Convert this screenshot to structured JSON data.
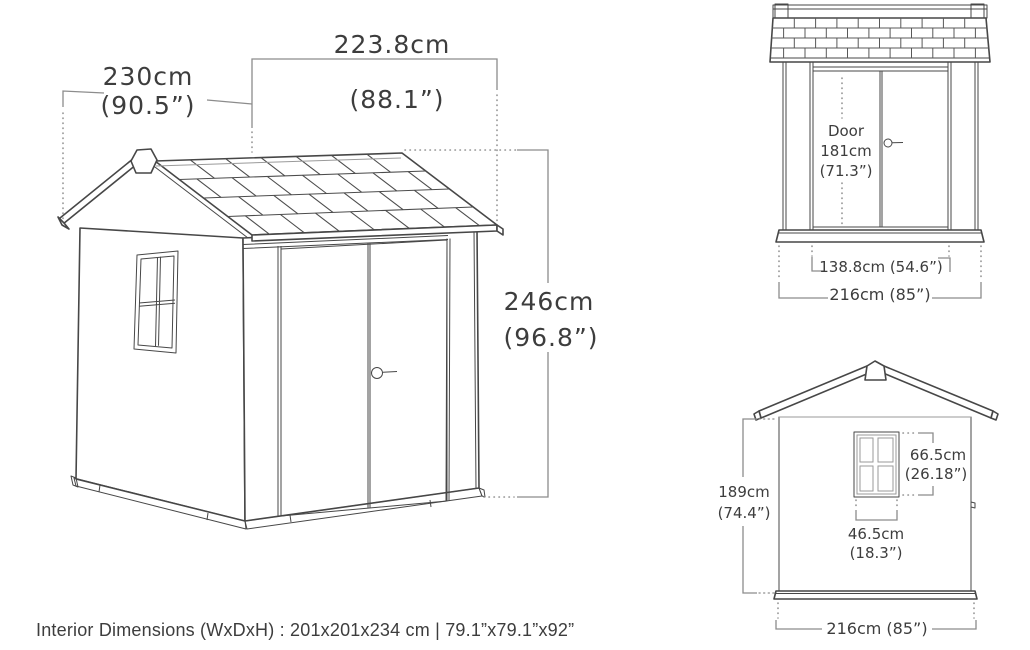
{
  "colors": {
    "outline": "#474747",
    "dim_line": "#8c8c8c",
    "text": "#3d3d3d",
    "background": "#ffffff"
  },
  "main_view": {
    "depth_cm": "230cm",
    "depth_in": "(90.5”)",
    "roof_width_cm": "223.8cm",
    "roof_width_in": "(88.1”)",
    "height_cm": "246cm",
    "height_in": "(96.8”)"
  },
  "front_view": {
    "door_label": "Door",
    "door_height_cm": "181cm",
    "door_height_in": "(71.3”)",
    "door_opening_width": "138.8cm (54.6”)",
    "overall_width": "216cm (85”)"
  },
  "side_view": {
    "wall_height_cm": "189cm",
    "wall_height_in": "(74.4”)",
    "window_height_cm": "66.5cm",
    "window_height_in": "(26.18”)",
    "window_width_cm": "46.5cm",
    "window_width_in": "(18.3”)",
    "overall_width": "216cm (85”)"
  },
  "footer": {
    "interior_dimensions": "Interior Dimensions (WxDxH) : 201x201x234 cm | 79.1”x79.1”x92”"
  }
}
